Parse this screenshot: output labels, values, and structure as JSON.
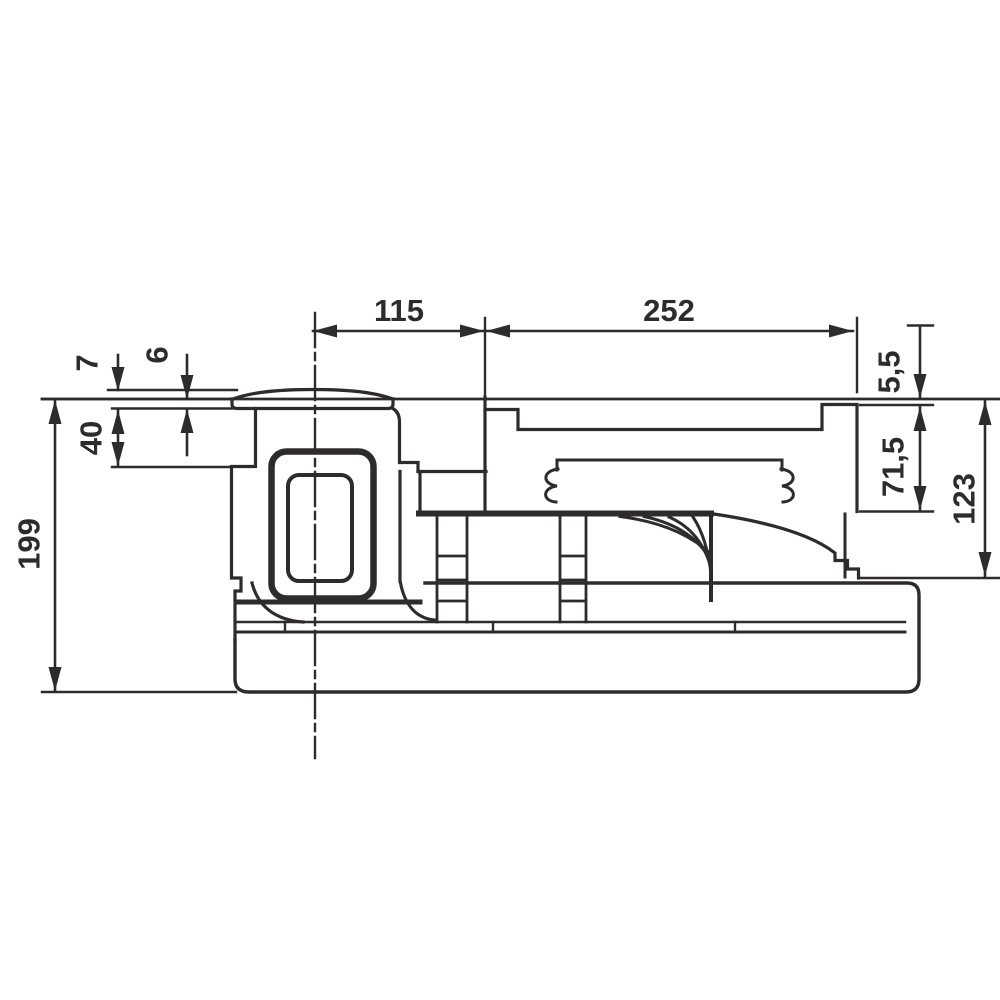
{
  "drawing": {
    "kind": "dimensioned technical side-elevation drawing",
    "line_color": "#2e2b2c",
    "background_color": "#ffffff",
    "units_style": "decimal-comma",
    "dims": {
      "top": [
        "115",
        "252"
      ],
      "left": [
        "7",
        "6",
        "40",
        "199"
      ],
      "right": [
        "5,5",
        "71,5",
        "123"
      ]
    }
  }
}
